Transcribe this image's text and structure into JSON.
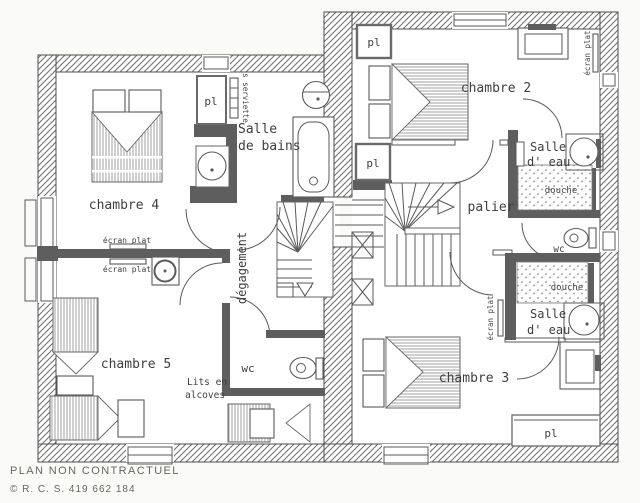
{
  "colors": {
    "paper": "#fafaf8",
    "ink": "#4a4a4a",
    "wall_dark": "#5e5e5e",
    "hatch_line": "#6e6e6e"
  },
  "footer": {
    "disclaimer": "PLAN NON CONTRACTUEL",
    "copyright": "© R. C. S. 419 662 184"
  },
  "rooms": {
    "chambre2": "chambre 2",
    "chambre3": "chambre 3",
    "chambre4": "chambre 4",
    "chambre5": "chambre 5",
    "palier": "palier",
    "degagement": "dégagement",
    "wc_center": "wc",
    "wc_right": "wc",
    "salle_de_bains": {
      "line1": "Salle",
      "line2": "de bains"
    },
    "salle_eau_top": {
      "line1": "Salle",
      "line2": "d' eau"
    },
    "salle_eau_bottom": {
      "line1": "Salle",
      "line2": "d' eau"
    }
  },
  "annotations": {
    "placard": "pl",
    "ecran_plat": "écran plat",
    "seche_serviette": "s serviette",
    "douche": "douche",
    "lits_alcoves": {
      "line1": "Lits en",
      "line2": "alcoves"
    }
  }
}
